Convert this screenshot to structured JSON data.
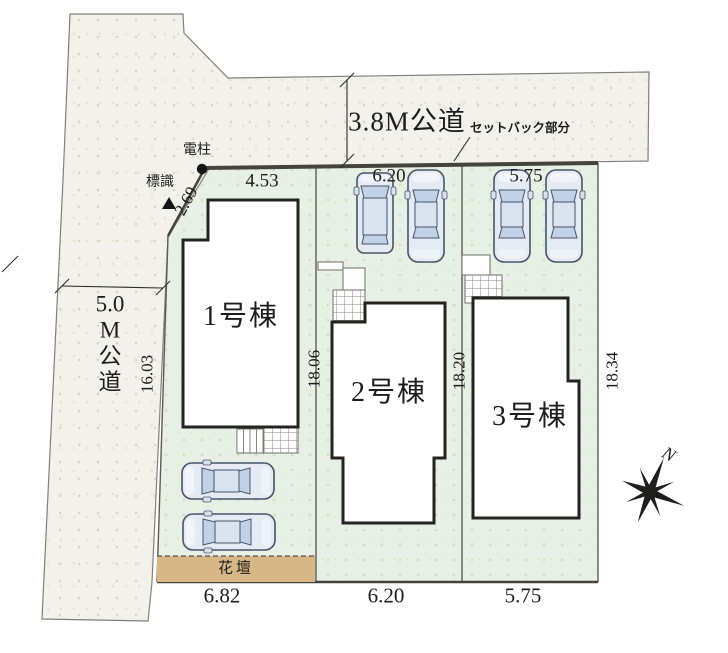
{
  "site_plan": {
    "top_road": {
      "label": "3.8M公道",
      "setback_label": "セットバック部分"
    },
    "left_road": {
      "label": "5.0M公道",
      "chars": [
        "5.0",
        "M",
        "公",
        "道"
      ],
      "length_dim": "16.03"
    },
    "markers": {
      "utility_pole": "電柱",
      "sign": "標識"
    },
    "lots": [
      {
        "name": "1号棟",
        "top_dim": "4.53",
        "corner_dim": "2.69",
        "depth_dim": "18.06",
        "frontage_dim": "6.82"
      },
      {
        "name": "2号棟",
        "top_dim": "6.20",
        "depth_dim": "18.20",
        "frontage_dim": "6.20"
      },
      {
        "name": "3号棟",
        "top_dim": "5.75",
        "depth_dim": "18.34",
        "frontage_dim": "5.75"
      }
    ],
    "flower_bed": {
      "label": "花壇"
    },
    "compass": {
      "label": "N"
    },
    "colors": {
      "lot_fill": "#e7f0e4",
      "road_fill": "#f3f1ec",
      "flower_bed_fill": "#d8b786",
      "outline": "#3c3c36",
      "car_body": "#e4ebf4",
      "car_glass": "#c2d2e6"
    }
  }
}
